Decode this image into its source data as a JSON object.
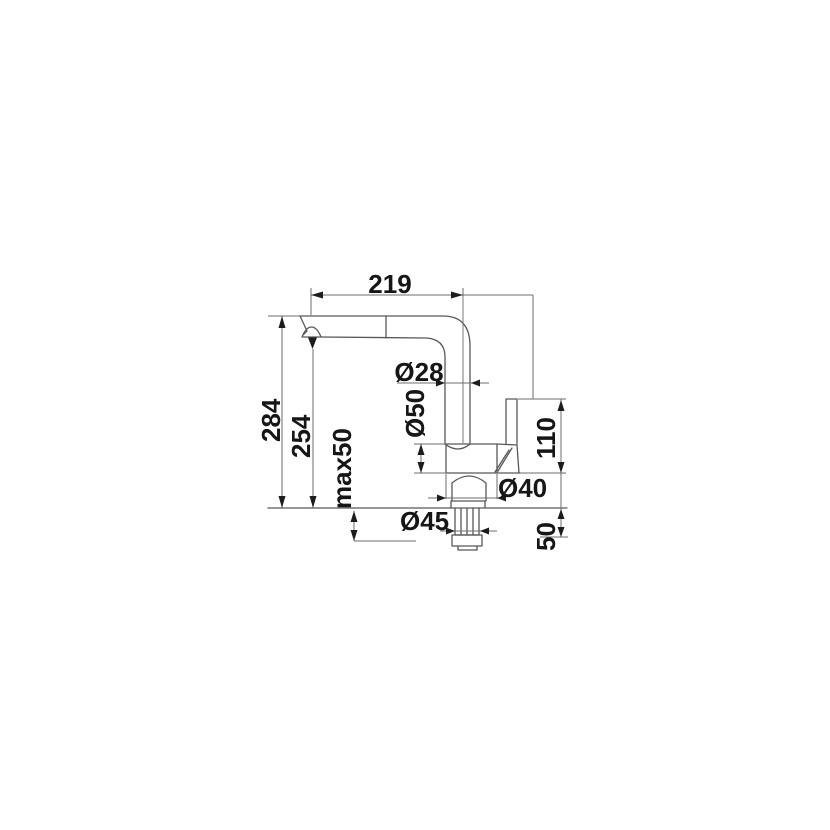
{
  "drawing": {
    "title": "kitchen-faucet-installation-dimension-drawing",
    "units": "mm",
    "dimensions": {
      "spout_reach": "219",
      "spout_pipe_diameter": "Ø28",
      "total_height": "284",
      "outlet_height": "254",
      "body_diameter": "Ø50",
      "max_deck_thickness": "max50",
      "lever_height": "110",
      "base_diameter": "Ø40",
      "stem_diameter": "Ø45",
      "under_deck_length": "50"
    },
    "colors": {
      "background": "#ffffff",
      "outline": "#585858",
      "dimension_line": "#6d6d6d",
      "text": "#161616"
    }
  }
}
